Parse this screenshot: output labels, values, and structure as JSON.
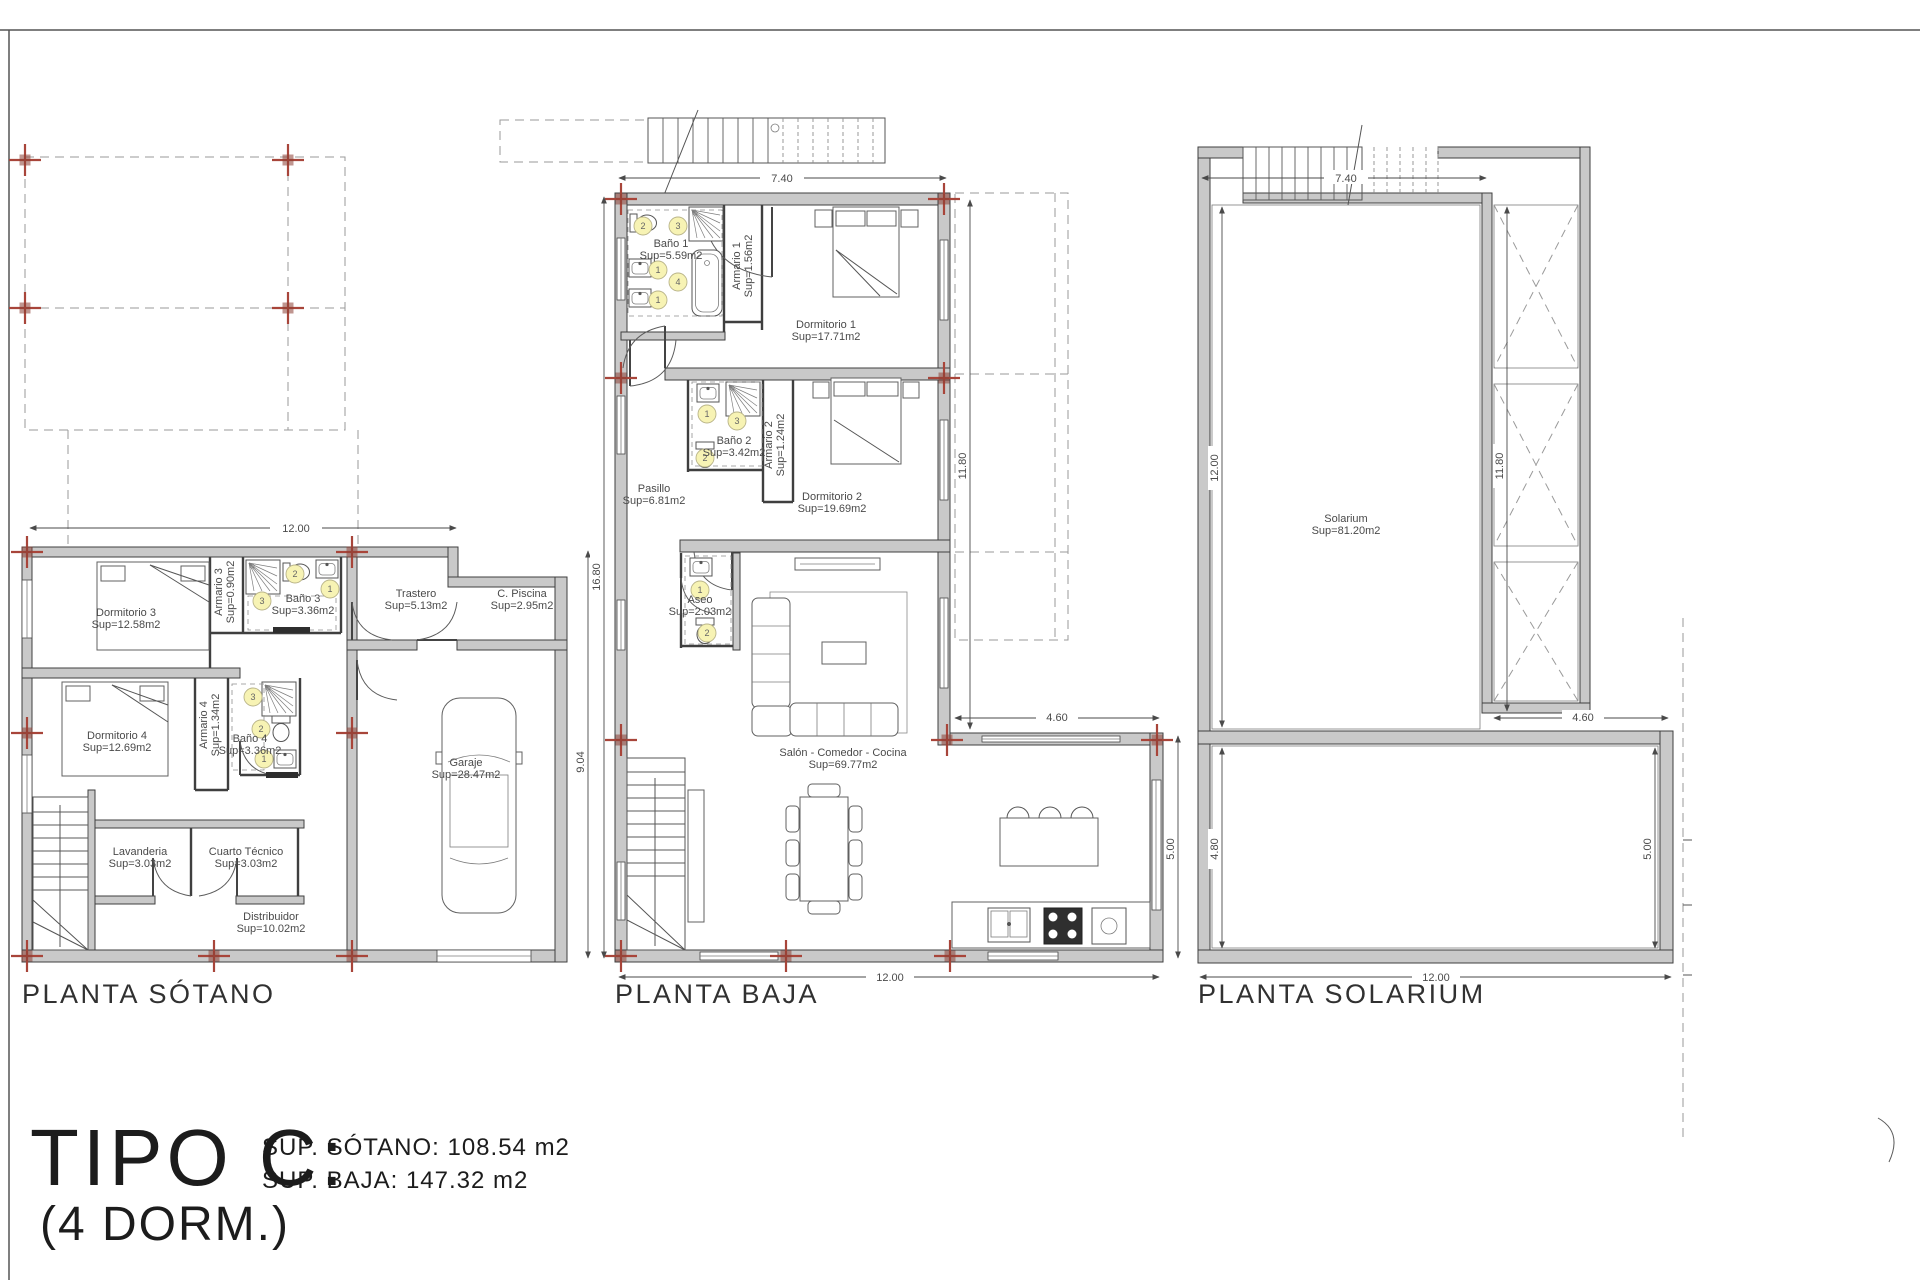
{
  "title_block": {
    "type_label": "TIPO C:",
    "dorm_label": "(4 DORM.)",
    "sup_sotano": "SUP. SÓTANO: 108.54 m2",
    "sup_baja": "SUP. BAJA: 147.32 m2"
  },
  "plans": {
    "sotano": {
      "label": "PLANTA SÓTANO",
      "rooms": {
        "dormitorio3": {
          "name": "Dormitorio 3",
          "area": "Sup=12.58m2"
        },
        "armario3": {
          "name": "Armario 3",
          "area": "Sup=0.90m2"
        },
        "bano3": {
          "name": "Baño 3",
          "area": "Sup=3.36m2"
        },
        "trastero": {
          "name": "Trastero",
          "area": "Sup=5.13m2"
        },
        "c_piscina": {
          "name": "C. Piscina",
          "area": "Sup=2.95m2"
        },
        "dormitorio4": {
          "name": "Dormitorio 4",
          "area": "Sup=12.69m2"
        },
        "armario4": {
          "name": "Armario 4",
          "area": "Sup=1.34m2"
        },
        "bano4": {
          "name": "Baño 4",
          "area": "Sup=3.36m2"
        },
        "lavanderia": {
          "name": "Lavanderia",
          "area": "Sup=3.03m2"
        },
        "cuarto_tecnico": {
          "name": "Cuarto Técnico",
          "area": "Sup=3.03m2"
        },
        "distribuidor": {
          "name": "Distribuidor",
          "area": "Sup=10.02m2"
        },
        "garaje": {
          "name": "Garaje",
          "area": "Sup=28.47m2"
        }
      },
      "dims": {
        "width": "12.00",
        "height": "9.04"
      }
    },
    "baja": {
      "label": "PLANTA BAJA",
      "rooms": {
        "bano1": {
          "name": "Baño 1",
          "area": "Sup=5.59m2"
        },
        "armario1": {
          "name": "Armario 1",
          "area": "Sup=1.56m2"
        },
        "dormitorio1": {
          "name": "Dormitorio 1",
          "area": "Sup=17.71m2"
        },
        "bano2": {
          "name": "Baño 2",
          "area": "Sup=3.42m2"
        },
        "armario2": {
          "name": "Armario 2",
          "area": "Sup=1.24m2"
        },
        "dormitorio2": {
          "name": "Dormitorio 2",
          "area": "Sup=19.69m2"
        },
        "pasillo": {
          "name": "Pasillo",
          "area": "Sup=6.81m2"
        },
        "aseo": {
          "name": "Aseo",
          "area": "Sup=2.03m2"
        },
        "salon": {
          "name": "Salón - Comedor - Cocina",
          "area": "Sup=69.77m2"
        }
      },
      "dims": {
        "top": "7.40",
        "left": "16.80",
        "right": "11.80",
        "step": "4.60",
        "side": "5.00",
        "bottom": "12.00"
      }
    },
    "solarium": {
      "label": "PLANTA SOLARIUM",
      "rooms": {
        "solarium": {
          "name": "Solarium",
          "area": "Sup=81.20m2"
        }
      },
      "dims": {
        "top": "7.40",
        "left": "12.00",
        "inner": "11.80",
        "step": "4.60",
        "terrace_left": "4.80",
        "terrace_right": "5.00",
        "bottom": "12.00"
      }
    }
  },
  "markers": {
    "n1": "1",
    "n2": "2",
    "n3": "3",
    "n4": "4"
  },
  "colors": {
    "wall_fill": "#c9c9c9",
    "line": "#3f3f3f",
    "cross_red": "#a8453a",
    "marker_fill": "#f7f3b4",
    "text": "#4a4a4a"
  }
}
